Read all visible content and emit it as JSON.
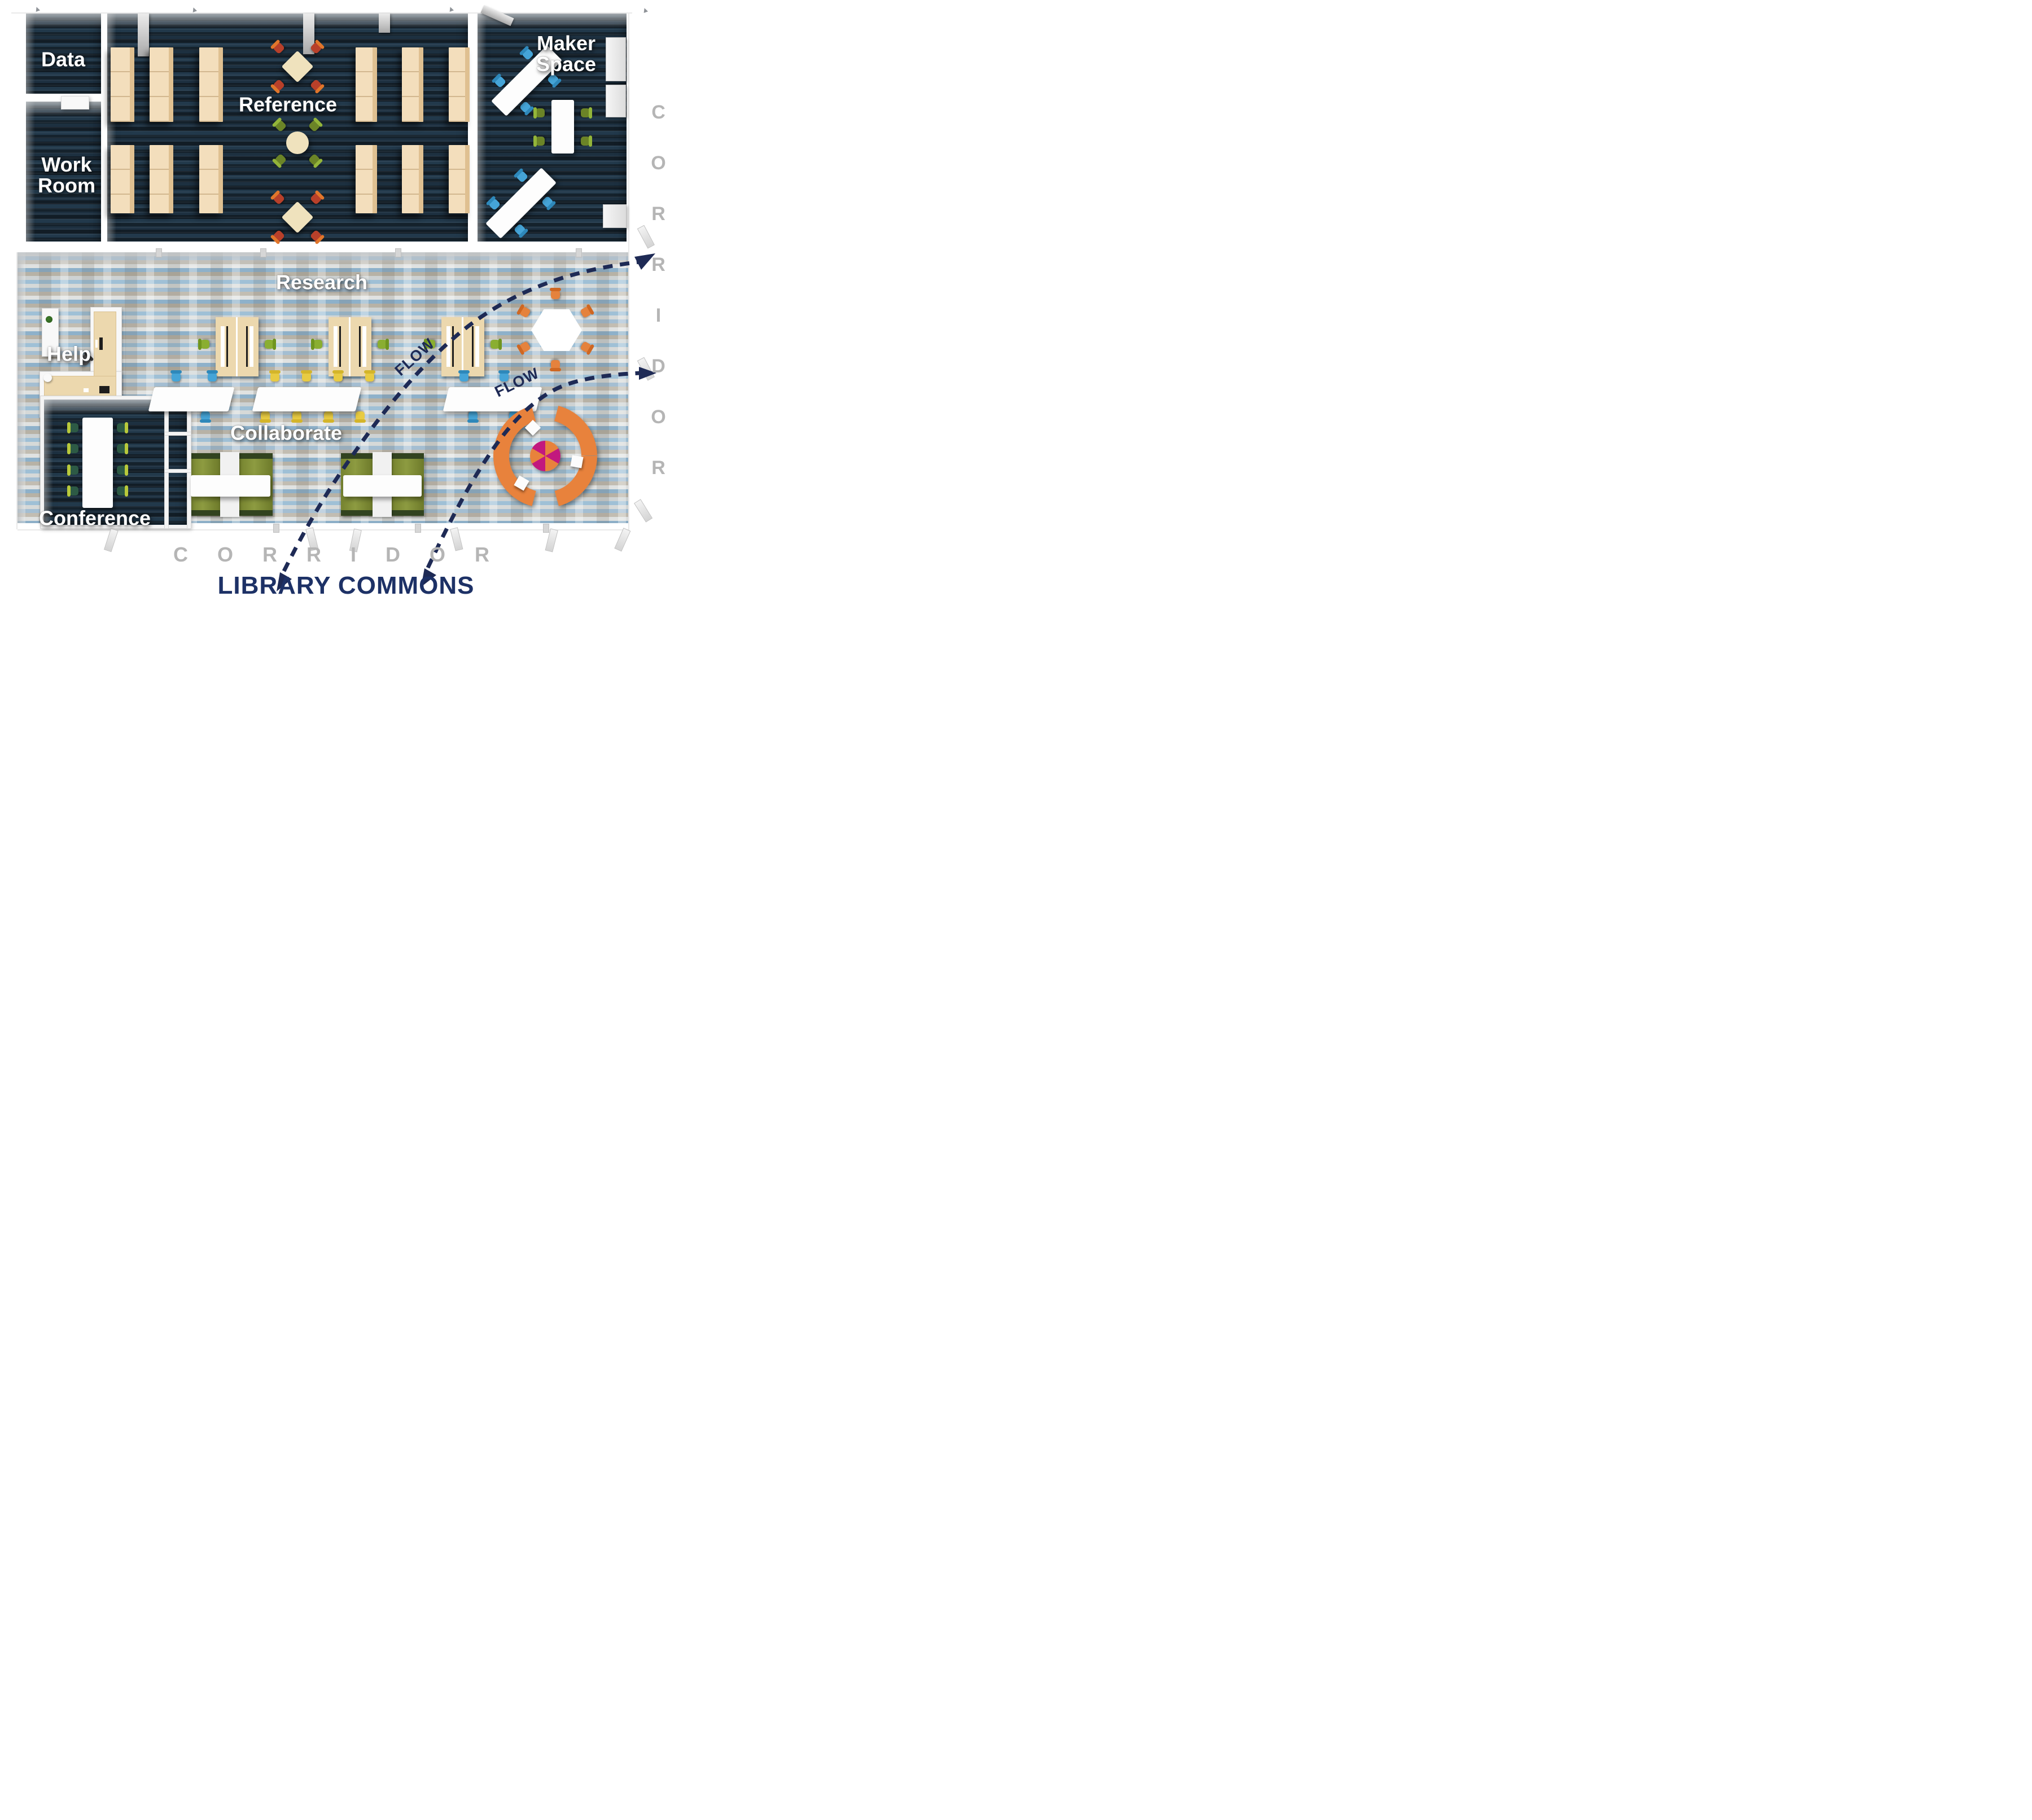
{
  "title": {
    "text": "LIBRARY COMMONS"
  },
  "areas": {
    "data": {
      "label": "Data"
    },
    "work_room": {
      "label": "Work\nRoom"
    },
    "reference": {
      "label": "Reference"
    },
    "maker_space": {
      "label": "Maker\nSpace"
    },
    "research": {
      "label": "Research"
    },
    "help": {
      "label": "Help"
    },
    "collaborate": {
      "label": "Collaborate"
    },
    "conference": {
      "label": "Conference"
    }
  },
  "flow": {
    "label": "FLOW"
  },
  "corridor": {
    "right_label": "CORRIDOR",
    "bottom_label": "CORRIDOR"
  },
  "palette": {
    "flow_navy": "#1e2a55",
    "title_navy": "#1d3166",
    "corridor_gray": "#b5b5b5",
    "dark_carpet": "#182634",
    "brick_carpet_blue": "#9fc0d6",
    "brick_carpet_tan": "#b7b2a6",
    "bookshelf_tan": "#f3debc",
    "chair_red": "#b8402a",
    "chair_orange_trim": "#e1762b",
    "chair_green": "#6b8427",
    "chair_research_green": "#8aae31",
    "chair_blue": "#45a4d7",
    "chair_yellow": "#e8cb42",
    "chair_orange": "#e5823d",
    "conference_chair_green": "#2d5a45",
    "sofa_orange": "#e8823c",
    "ottoman_magenta": "#c2187e"
  }
}
